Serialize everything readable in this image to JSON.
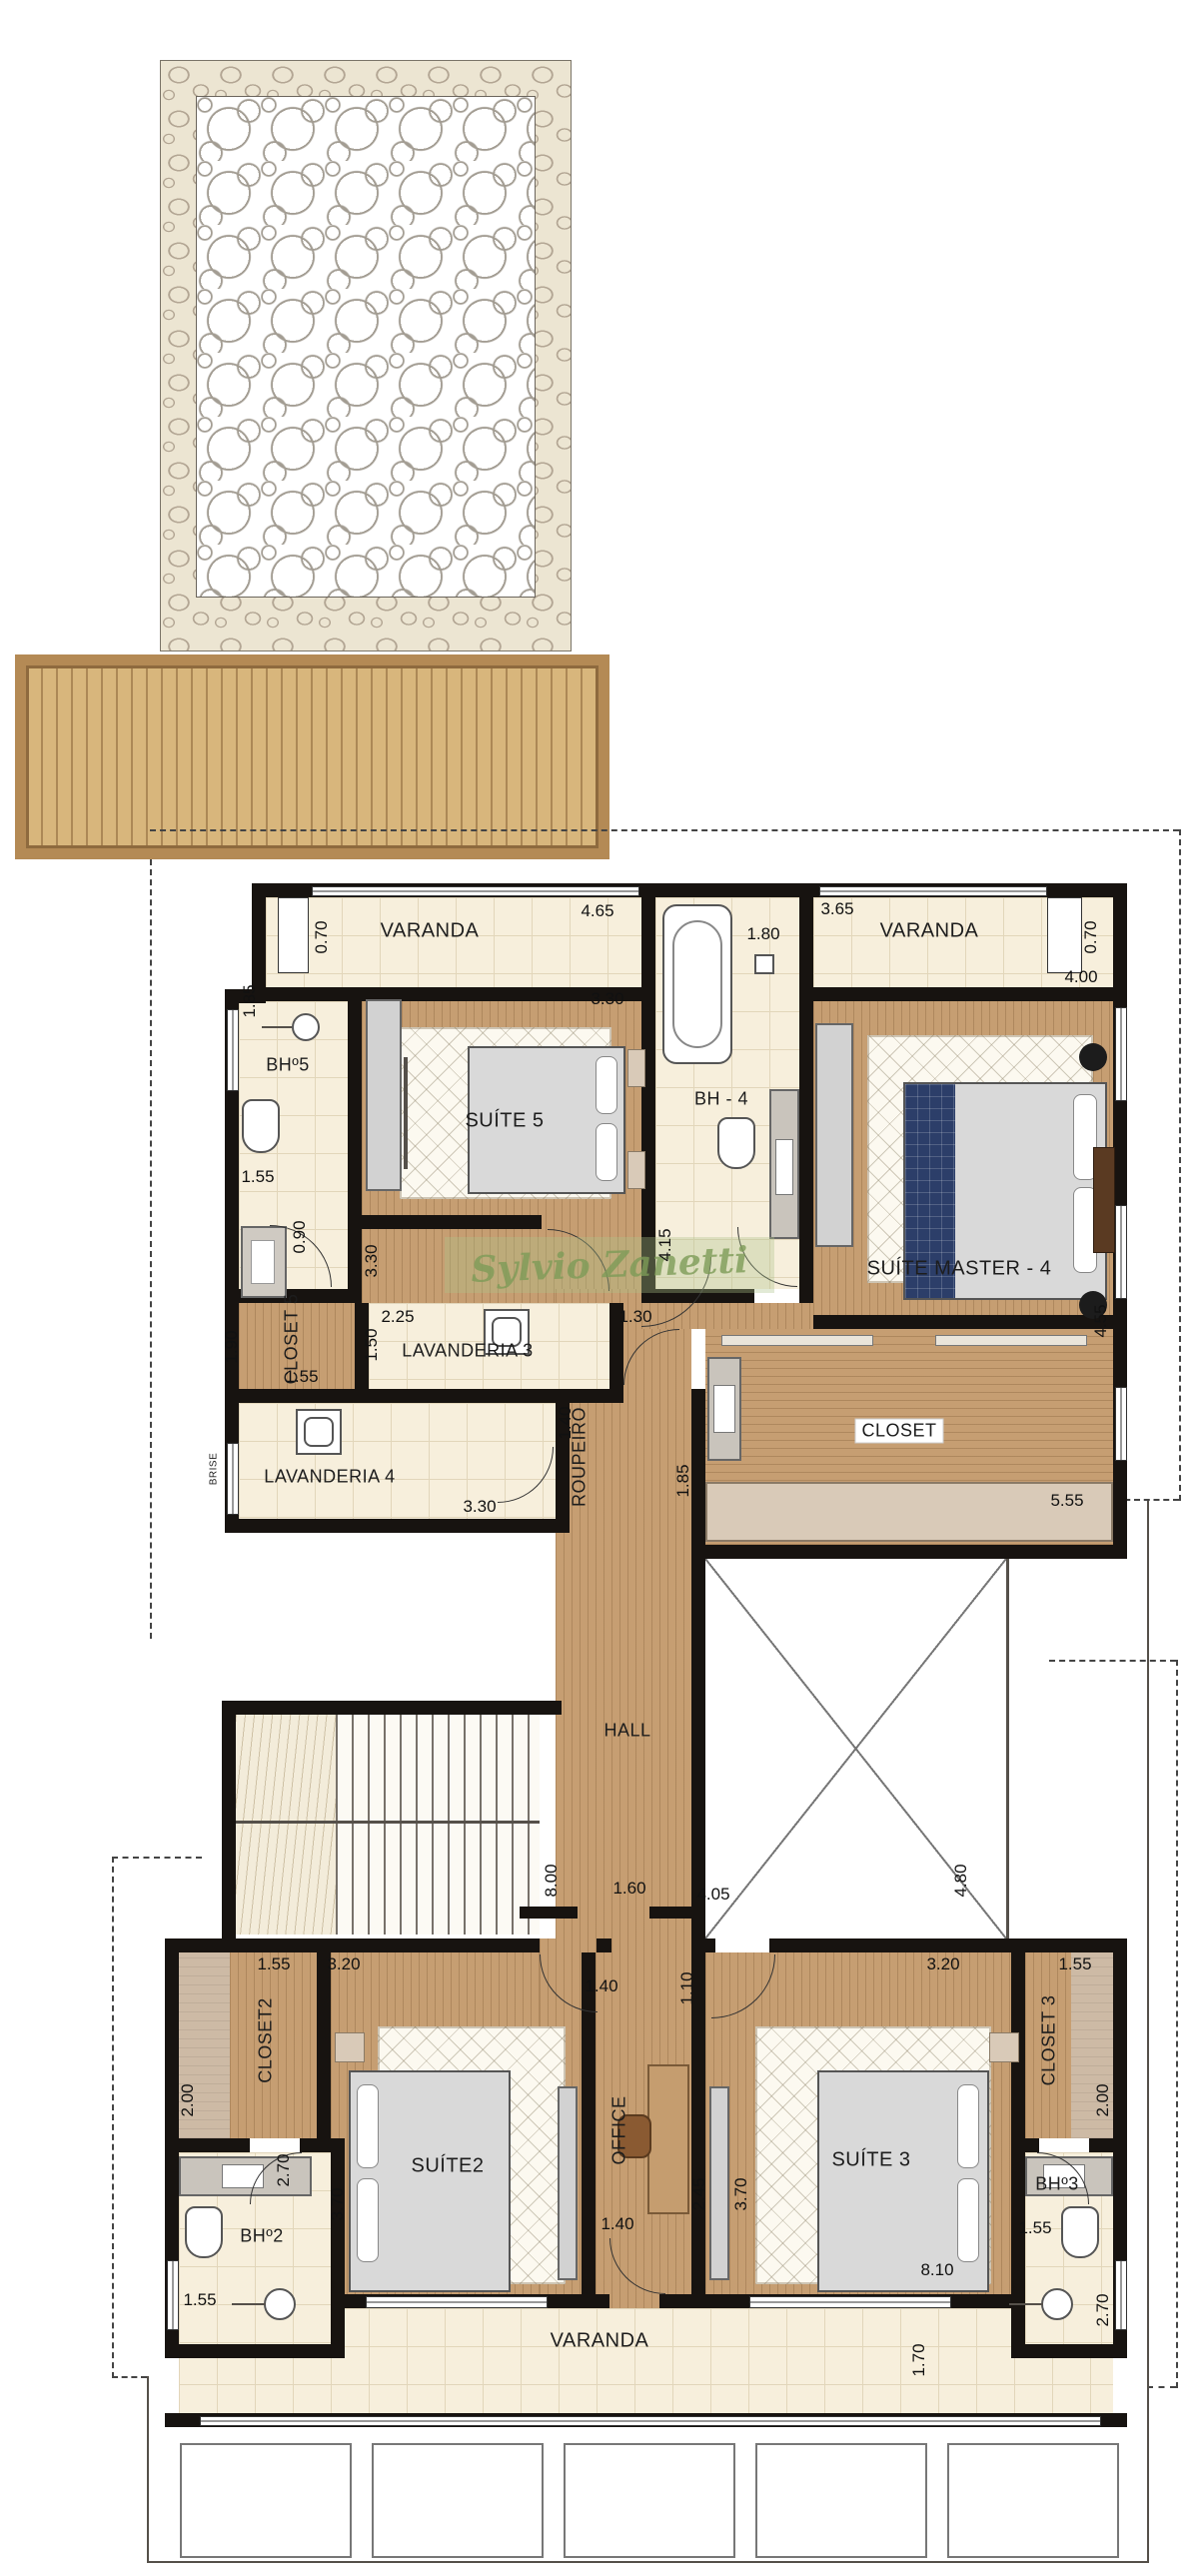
{
  "watermark": "Sylvio Zanetti",
  "labels": {
    "varanda_left": "VARANDA",
    "varanda_right": "VARANDA",
    "varanda_bottom": "VARANDA",
    "bh5": "BHº5",
    "bh4": "BH - 4",
    "bh2": "BHº2",
    "bh3": "BHº3",
    "suite5": "SUÍTE 5",
    "suite_master": "SUÍTE MASTER - 4",
    "suite2": "SUÍTE2",
    "suite3": "SUÍTE 3",
    "closet5": "CLOSET 5",
    "closet_master": "CLOSET",
    "closet2": "CLOSET2",
    "closet3": "CLOSET 3",
    "lavanderia3": "LAVANDERIA 3",
    "lavanderia4": "LAVANDERIA 4",
    "roupeiro": "ROUPEIRO",
    "office": "OFFICE",
    "hall": "HALL",
    "brise": "BRISE"
  },
  "dims": {
    "varanda_left_width": "4.65",
    "varanda_left_depth": "0.70",
    "varanda_right_width": "3.65",
    "varanda_right_depth": "0.70",
    "bh4_width": "1.80",
    "bh4_depth": "4.15",
    "master_width": "4.00",
    "master_depth": "4.55",
    "suite5_width": "3.30",
    "suite5_depth": "3.30",
    "bh5_width_top": "1.85",
    "bh5_width_bottom": "1.55",
    "closet5_shower": "0.90",
    "closet5_depth": "1.90",
    "closet5_width": "1.55",
    "lav3_width": "2.25",
    "lav3_depth": "1.50",
    "lav4_width": "3.30",
    "lav4_door": "1.40",
    "hall_door_bh4": "1.30",
    "closet_master_depth": "1.85",
    "closet_master_width": "5.55",
    "stair_well": "8.00",
    "hall_opening": "1.60",
    "void_width": "4.05",
    "void_depth": "4.80",
    "closet2_width": "1.55",
    "closet2_depth": "2.00",
    "closet2_door": "2.70",
    "suite2_width": "3.20",
    "suite2_depth": "3.70",
    "suite2_door": "1.40",
    "office_top_door": "1.10",
    "office_bottom_door": "1.40",
    "office_depth": "2.45",
    "suite3_width": "3.20",
    "suite3_depth": "3.70",
    "closet3_width": "1.55",
    "closet3_depth": "2.00",
    "bh2_lower_width": "1.55",
    "bh3_width": "1.55",
    "bh3_lower_depth": "2.70",
    "varanda_bottom_width": "8.10",
    "varanda_bottom_depth": "1.70"
  },
  "colors": {
    "wall": "#171310",
    "wood_floor": "#c69e72",
    "tile_floor": "#f7efdc",
    "closet_floor": "#cdbaa5",
    "bed_runner_blue": "#2c3e69",
    "deck": "#d8b67c",
    "watermark_green": "#7d9b58"
  }
}
